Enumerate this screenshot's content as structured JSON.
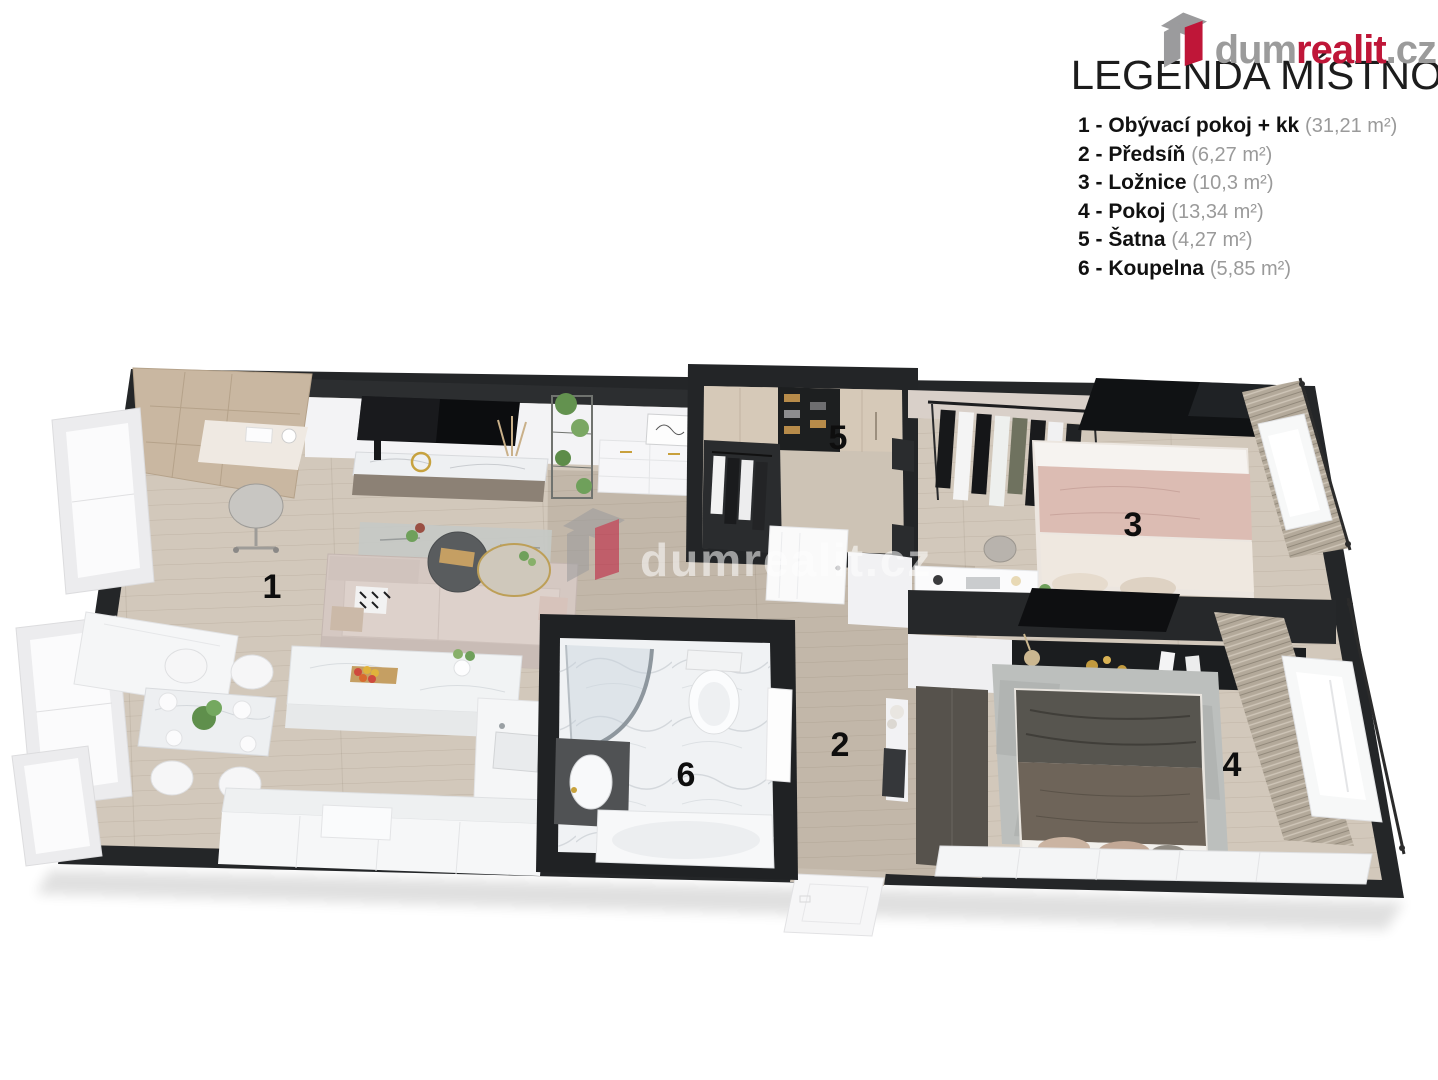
{
  "brand": {
    "dum": "dum",
    "realit": "realit",
    "cz": ".cz",
    "color_gray": "#9b9b9b",
    "color_red": "#bf1638"
  },
  "legend": {
    "title": "LEGENDA MÍSTNOSTÍ",
    "rooms": [
      {
        "label": "1 - Obývací pokoj + kk",
        "area": "(31,21 m²)"
      },
      {
        "label": "2 - Předsíň",
        "area": "(6,27 m²)"
      },
      {
        "label": "3 - Ložnice",
        "area": "(10,3 m²)"
      },
      {
        "label": "4 - Pokoj",
        "area": "(13,34 m²)"
      },
      {
        "label": "5 - Šatna",
        "area": "(4,27 m²)"
      },
      {
        "label": "6 - Koupelna",
        "area": "(5,85 m²)"
      }
    ]
  },
  "floorplan": {
    "watermark": "dumrealit.cz",
    "room_numbers": {
      "living": "1",
      "hallway": "2",
      "bedroom3": "3",
      "bedroom4": "4",
      "closet": "5",
      "bathroom": "6"
    },
    "colors": {
      "wall_dark": "#242628",
      "floor_wood": "#d2c8bb",
      "floor_hall": "#c2b7a9",
      "floor_marble": "#f0f2f4",
      "curtain": "#b3a99a"
    }
  }
}
